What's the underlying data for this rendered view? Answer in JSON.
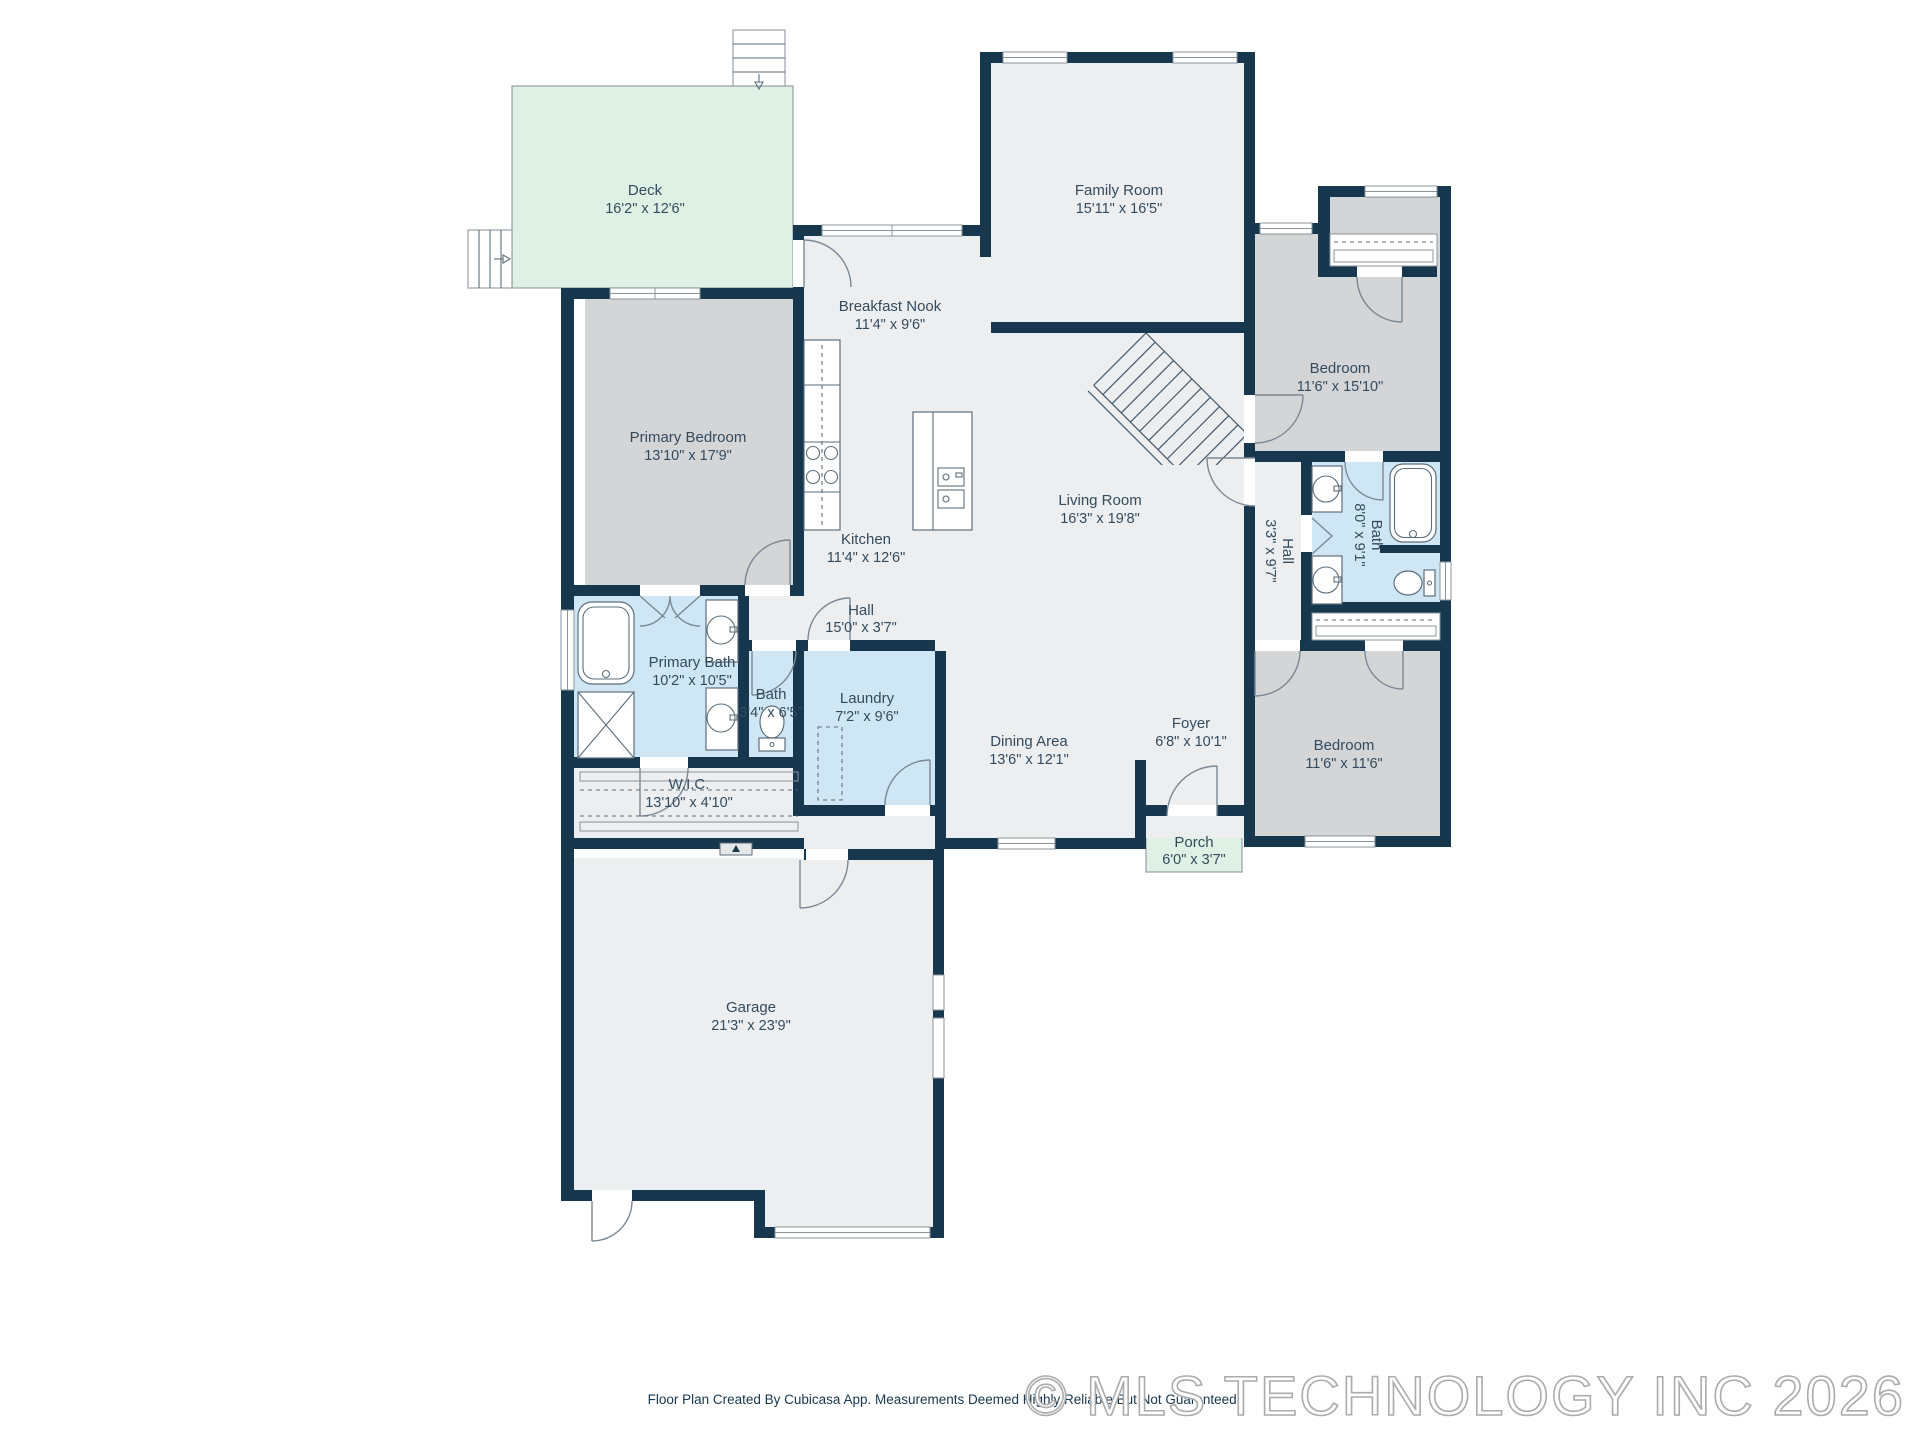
{
  "colors": {
    "wall": "#17374e",
    "floor": "#eceef0",
    "bedroom_floor": "#d3d5d7",
    "bath_floor": "#cfe7f5",
    "outdoor_floor": "#def1e4",
    "label_text": "#344b5e",
    "watermark": "#ababab"
  },
  "rooms": [
    {
      "id": "deck",
      "name": "Deck",
      "dims": "16'2\" x 12'6\""
    },
    {
      "id": "family-room",
      "name": "Family Room",
      "dims": "15'11\" x 16'5\""
    },
    {
      "id": "breakfast-nook",
      "name": "Breakfast Nook",
      "dims": "11'4\" x 9'6\""
    },
    {
      "id": "primary-bedroom",
      "name": "Primary Bedroom",
      "dims": "13'10\" x 17'9\""
    },
    {
      "id": "kitchen",
      "name": "Kitchen",
      "dims": "11'4\" x 12'6\""
    },
    {
      "id": "living-room",
      "name": "Living Room",
      "dims": "16'3\" x 19'8\""
    },
    {
      "id": "bedroom-top-right",
      "name": "Bedroom",
      "dims": "11'6\" x 15'10\""
    },
    {
      "id": "hall-right",
      "name": "Hall",
      "dims": "3'3\" x 9'7\""
    },
    {
      "id": "bath-right",
      "name": "Bath",
      "dims": "8'0\" x 9'1\""
    },
    {
      "id": "primary-bath",
      "name": "Primary Bath",
      "dims": "10'2\" x 10'5\""
    },
    {
      "id": "bath-small",
      "name": "Bath",
      "dims": "3'4\" x 6'5\""
    },
    {
      "id": "hall-main",
      "name": "Hall",
      "dims": "15'0\" x 3'7\""
    },
    {
      "id": "laundry",
      "name": "Laundry",
      "dims": "7'2\" x 9'6\""
    },
    {
      "id": "wic",
      "name": "W.I.C.",
      "dims": "13'10\" x 4'10\""
    },
    {
      "id": "dining-area",
      "name": "Dining Area",
      "dims": "13'6\" x 12'1\""
    },
    {
      "id": "foyer",
      "name": "Foyer",
      "dims": "6'8\" x 10'1\""
    },
    {
      "id": "bedroom-bottom-right",
      "name": "Bedroom",
      "dims": "11'6\" x 11'6\""
    },
    {
      "id": "porch",
      "name": "Porch",
      "dims": "6'0\" x 3'7\""
    },
    {
      "id": "garage",
      "name": "Garage",
      "dims": "21'3\" x 23'9\""
    }
  ],
  "footer": {
    "disclaimer": "Floor Plan Created By Cubicasa App. Measurements Deemed Highly Reliable But Not Guaranteed."
  },
  "watermark": {
    "text": "© MLS TECHNOLOGY INC 2026"
  }
}
